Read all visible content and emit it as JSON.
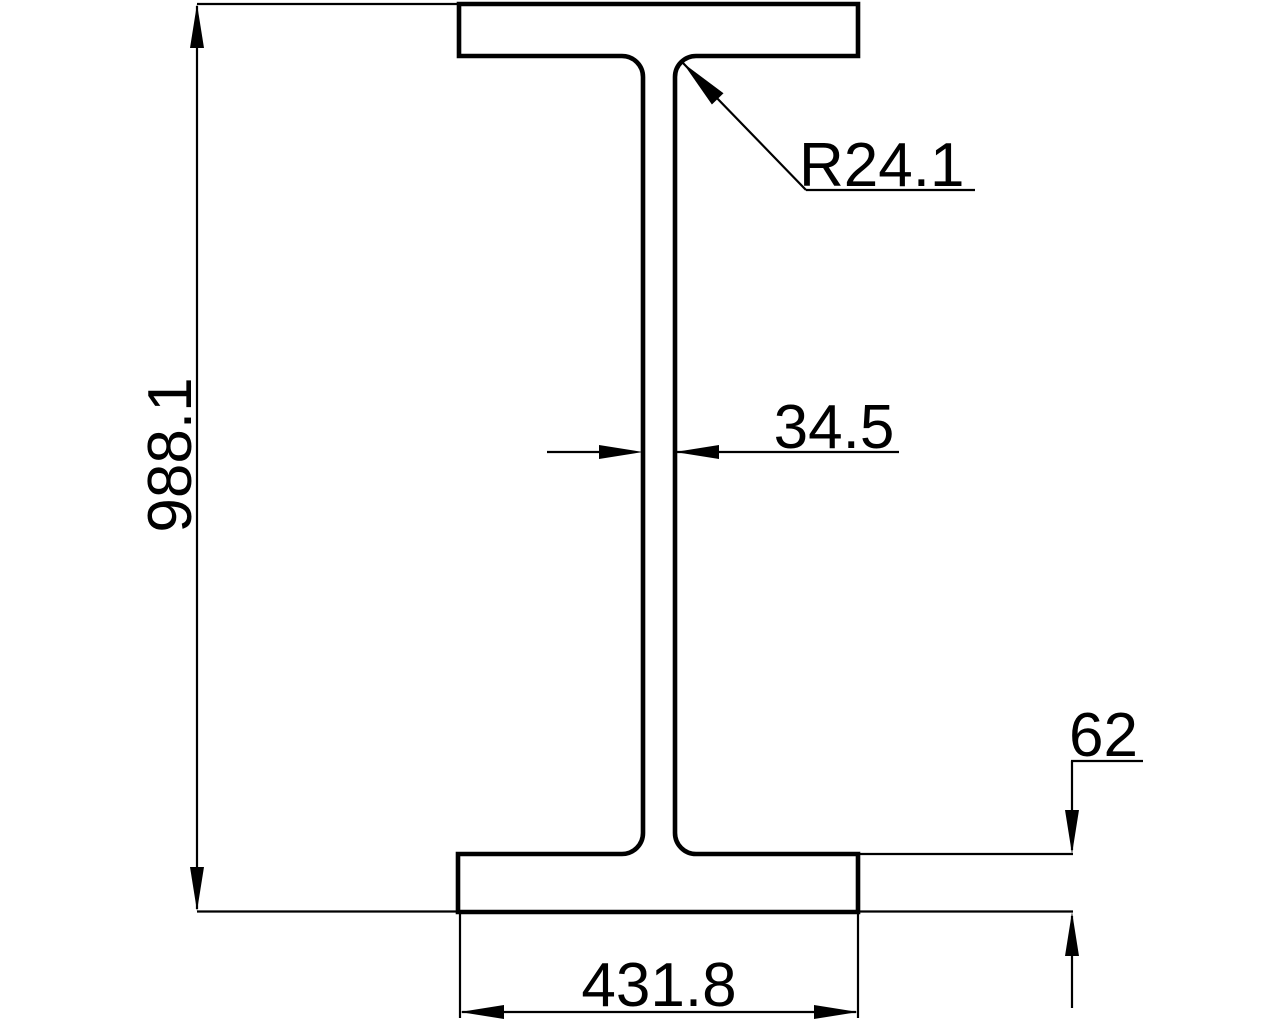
{
  "drawing": {
    "description": "Engineering drawing of an I-beam (wide-flange) cross-section with dimensions",
    "background_color": "#ffffff",
    "line_color": "#000000",
    "labels": {
      "overall_height": "988.1",
      "flange_width": "431.8",
      "web_thickness": "34.5",
      "flange_thickness": "62",
      "fillet_radius": "R24.1"
    }
  }
}
